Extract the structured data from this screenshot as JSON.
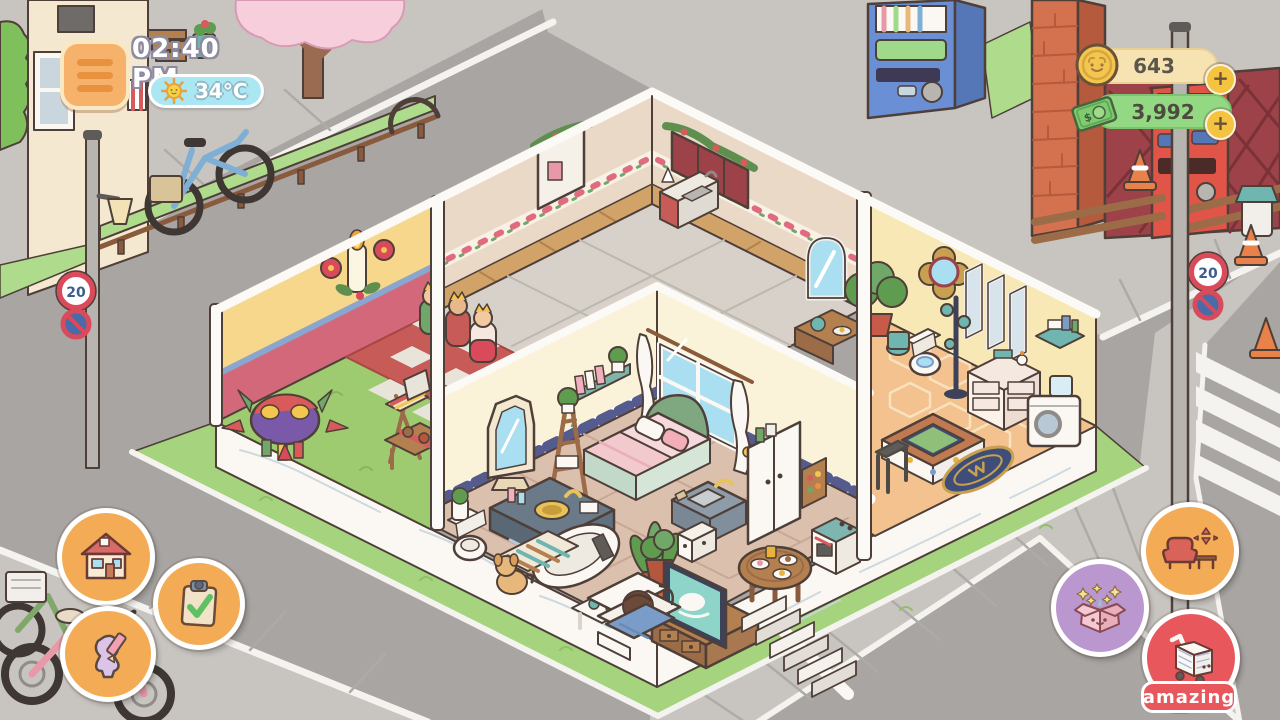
{
  "hud": {
    "time": "02:40 PM",
    "temperature": "34°C",
    "coins": "643",
    "cash": "3,992",
    "add_label": "+"
  },
  "street": {
    "speed_limit": "20"
  },
  "shop_badge": "amazing",
  "icons": {
    "menu": "hamburger-menu",
    "weather": "sun",
    "coins": "cat-coin",
    "cash": "cat-bill",
    "home": "house",
    "tasks": "clipboard-check",
    "character": "person-pencil",
    "furniture": "sofa-move-arrows",
    "gifts": "gift-box-stars",
    "shop": "shopping-cart"
  },
  "colors": {
    "road": "#A8A5A3",
    "sidewalk": "#C8C5C1",
    "grass": "#A6D47E",
    "hud_orange": "#F3AC55",
    "hud_purple": "#BA97CF",
    "hud_red": "#E8575C",
    "coin_gold": "#F2C64F",
    "cash_green": "#93D984",
    "weather_blue": "#ABE7F2",
    "wall_cream": "#FBF3D9",
    "wall_yellow": "#F6D78C",
    "wall_red": "#D2687A",
    "wall_beige": "#EAD9C6",
    "bath_floor": "#F4C28E",
    "bedroom_floor": "#DCC0AE"
  }
}
